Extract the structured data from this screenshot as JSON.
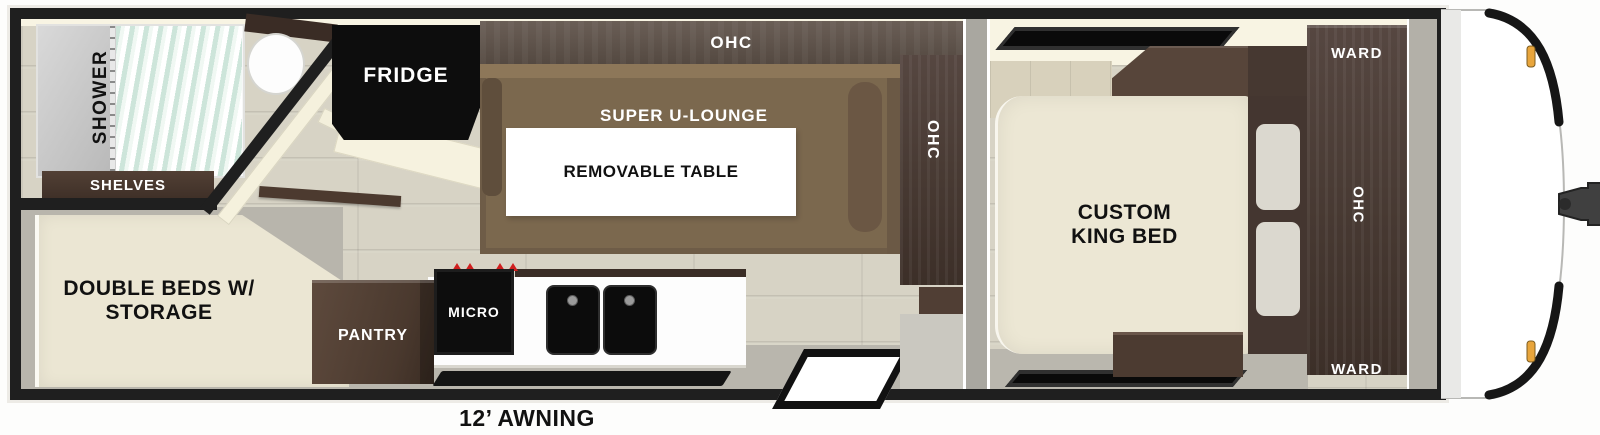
{
  "floorplan": {
    "type": "travel-trailer floorplan, top-down 3D render",
    "labels": {
      "shower": "SHOWER",
      "shelves": "SHELVES",
      "double_beds_1": "DOUBLE BEDS W/",
      "double_beds_2": "STORAGE",
      "fridge": "FRIDGE",
      "ohc": "OHC",
      "super_u_lounge": "SUPER U-LOUNGE",
      "removable_table": "REMOVABLE TABLE",
      "pantry": "PANTRY",
      "micro": "MICRO",
      "king_bed_1": "CUSTOM",
      "king_bed_2": "KING BED",
      "ward": "WARD",
      "awning": "12’ AWNING"
    },
    "colors": {
      "wall_black": "#1f1f1f",
      "floor_plank": "#d7d3c5",
      "cabinet_dark_wood": "#4a3b33",
      "lounge_brown": "#7b684e",
      "bed_cream": "#ece7d4",
      "counter_white": "#ffffff",
      "appliance_black": "#0d0d0d",
      "shower_glass_mint": "#cde5da",
      "burner_red": "#cf1f1f",
      "marker_light_amber": "#e8a53c",
      "floor_gray": "#b9b6ad"
    }
  }
}
